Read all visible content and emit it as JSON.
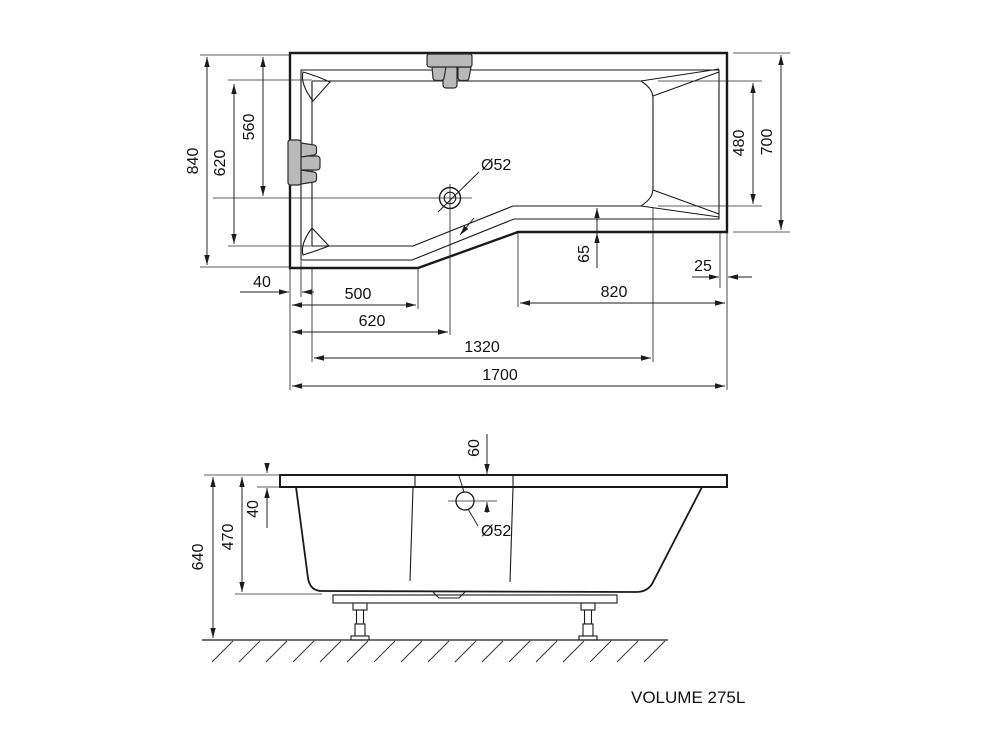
{
  "colors": {
    "line": "#1a1a1a",
    "tub_fill_top": "#e9e9e9",
    "tub_fill_side": "#fafafa",
    "fixture_gray": "#b9b9b9",
    "background": "#ffffff"
  },
  "top_view": {
    "dims": {
      "outer_width_left": "840",
      "basin_width_left": "620",
      "drain_from_top": "560",
      "basin_width_right": "480",
      "outer_width_right": "700",
      "rim_left": "40",
      "to_outer_bend": "500",
      "drain_from_left": "620",
      "basin_floor_length": "1320",
      "overall_length": "1700",
      "bottom_right_edge": "820",
      "rim_right": "25",
      "rim_bottom_right": "65"
    },
    "drain_label": "Ø52"
  },
  "side_view": {
    "dims": {
      "overall_height": "640",
      "body_height": "470",
      "rim_thickness": "40",
      "drain_below_rim": "60"
    },
    "drain_label": "Ø52"
  },
  "footer": {
    "volume_label": "VOLUME 275L"
  }
}
